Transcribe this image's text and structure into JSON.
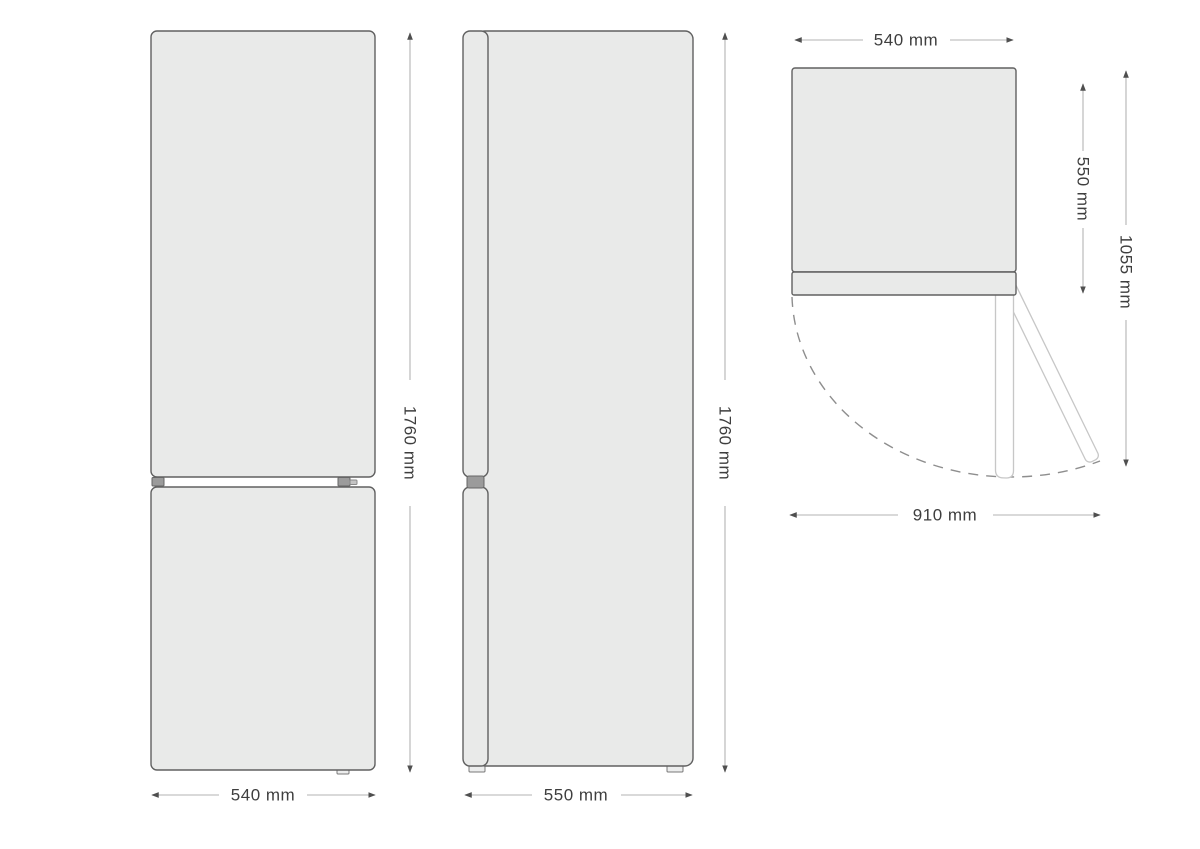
{
  "diagram": {
    "subject": "refrigerator-dimension-drawing",
    "colors": {
      "panel_fill": "#e9eae9",
      "panel_outline": "#606060",
      "dimension_line": "#b3b3b3",
      "dimension_text": "#3e3e3e",
      "swing_arc": "#8e8e8e"
    }
  },
  "views": {
    "front": {
      "width_label": "540 mm",
      "height_label": "1760 mm"
    },
    "side": {
      "depth_label": "550 mm",
      "height_label": "1760 mm"
    },
    "top": {
      "width_label": "540 mm",
      "body_depth_label": "550 mm",
      "door_open_depth_label": "1055 mm",
      "door_open_width_label": "910 mm"
    }
  }
}
